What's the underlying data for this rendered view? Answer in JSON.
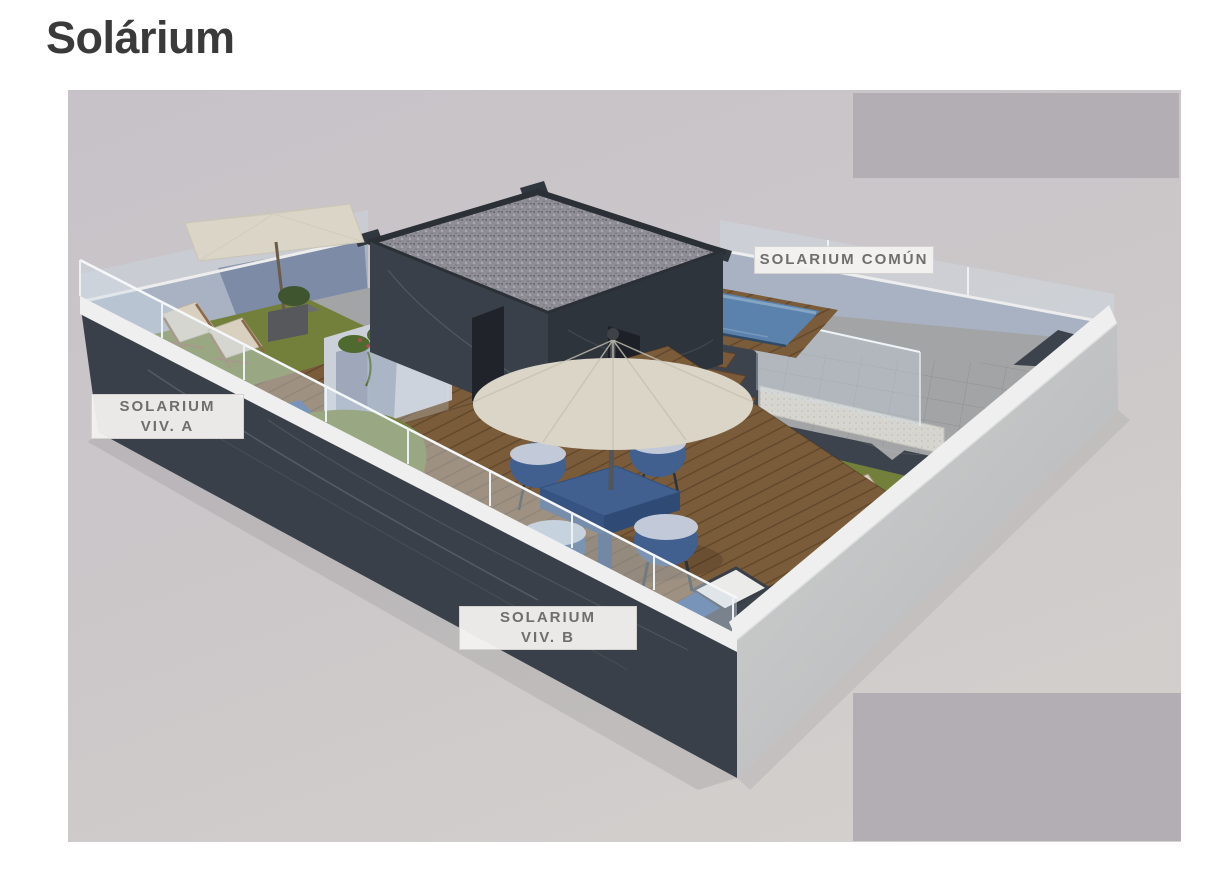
{
  "page": {
    "title": "Solárium"
  },
  "figure": {
    "labels": {
      "comun": "SOLARIUM COMÚN",
      "viv_a_line1": "SOLARIUM",
      "viv_a_line2": "VIV. A",
      "viv_b_line1": "SOLARIUM",
      "viv_b_line2": "VIV. B"
    }
  },
  "colors": {
    "title-color": "#3a3a3a",
    "photo-bg-top": "#c6c2c8",
    "photo-bg-bottom": "#d5d1cd",
    "watermark": "#b2aeb4",
    "label-border": "#d5d3d0",
    "label-text": "#6e6e6e",
    "wall-dark": "#3a4049",
    "wall-dark-deep": "#2e343c",
    "wall-stucco": "#a9b2c3",
    "coping-white": "#eeefee",
    "glass": "#cfdde8",
    "deck-wood": "#7a5b3a",
    "grass": "#73803c",
    "pool-water": "#5b82ad",
    "pool-water-light": "#8fadc8",
    "umbrella-cream": "#dad5c7",
    "furniture-blue": "#41608f",
    "wicker-light": "#c9d0dd",
    "stone-paving": "#a3a4a6",
    "marble-floor": "#3d434c",
    "plant-green": "#4e6a2f",
    "flower-red": "#b4494f",
    "shadow-blue": "#5a6c8f",
    "lounger-cream": "#d9d0c0",
    "wood-frame": "#8a6a4a",
    "step-wood": "#7a5a3a",
    "roof-gravel": "#8f8d95"
  }
}
